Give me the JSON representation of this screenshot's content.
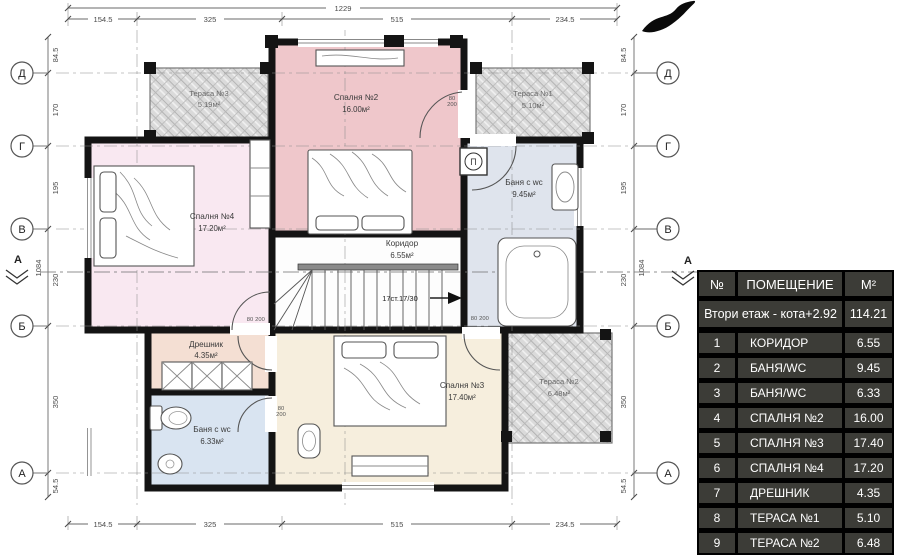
{
  "plan": {
    "grid_rows": [
      "Д",
      "Г",
      "В",
      "Б",
      "А"
    ],
    "section_label": "А",
    "dimensions": {
      "h_total": "1229",
      "h_segments": [
        "154.5",
        "325",
        "515",
        "234.5"
      ],
      "v_total": "1084",
      "v_segments": [
        "84.5",
        "170",
        "195",
        "230",
        "350",
        "54.5"
      ]
    },
    "rooms": [
      {
        "name": "Тераса №3",
        "area": "5.19м²"
      },
      {
        "name": "Спалня №2",
        "area": "16.00м²"
      },
      {
        "name": "Тераса №1",
        "area": "5.10м²"
      },
      {
        "name": "Спалня №4",
        "area": "17.20м²"
      },
      {
        "name": "Баня с wc",
        "area": "9.45м²"
      },
      {
        "name": "Коридор",
        "area": "6.55м²"
      },
      {
        "name": "Дрешник",
        "area": "4.35м²"
      },
      {
        "name": "Баня с wc",
        "area": "6.33м²"
      },
      {
        "name": "Спалня №3",
        "area": "17.40м²"
      },
      {
        "name": "Тераса №2",
        "area": "6.48м²"
      }
    ],
    "stairs_label": "17ст.17/30",
    "door_size": {
      "width": "80",
      "height": "200"
    },
    "boiler_label": "П"
  },
  "legend_table": {
    "headers": {
      "num": "№",
      "room": "ПОМЕЩЕНИЕ",
      "area": "М²"
    },
    "summary": {
      "label": "Втори етаж - кота+2.92",
      "area": "114.21"
    },
    "rows": [
      {
        "num": "1",
        "room": "КОРИДОР",
        "area": "6.55"
      },
      {
        "num": "2",
        "room": "БАНЯ/WC",
        "area": "9.45"
      },
      {
        "num": "3",
        "room": "БАНЯ/WC",
        "area": "6.33"
      },
      {
        "num": "4",
        "room": "СПАЛНЯ №2",
        "area": "16.00"
      },
      {
        "num": "5",
        "room": "СПАЛНЯ №3",
        "area": "17.40"
      },
      {
        "num": "6",
        "room": "СПАЛНЯ №4",
        "area": "17.20"
      },
      {
        "num": "7",
        "room": "ДРЕШНИК",
        "area": "4.35"
      },
      {
        "num": "8",
        "room": "ТЕРАСА №1",
        "area": "5.10"
      },
      {
        "num": "9",
        "room": "ТЕРАСА №2",
        "area": "6.48"
      }
    ]
  },
  "colors": {
    "bedroom2": "#efc7cb",
    "bedroom3": "#f6eedd",
    "bedroom4": "#f9e8f1",
    "bath_top": "#dfe4ed",
    "bath_bottom": "#d9e4f1",
    "dressing": "#f4dfd3",
    "corridor": "#fdfdfd",
    "wall": "#141414",
    "table_cell": "#3c3c37",
    "table_text": "#ffffff"
  }
}
